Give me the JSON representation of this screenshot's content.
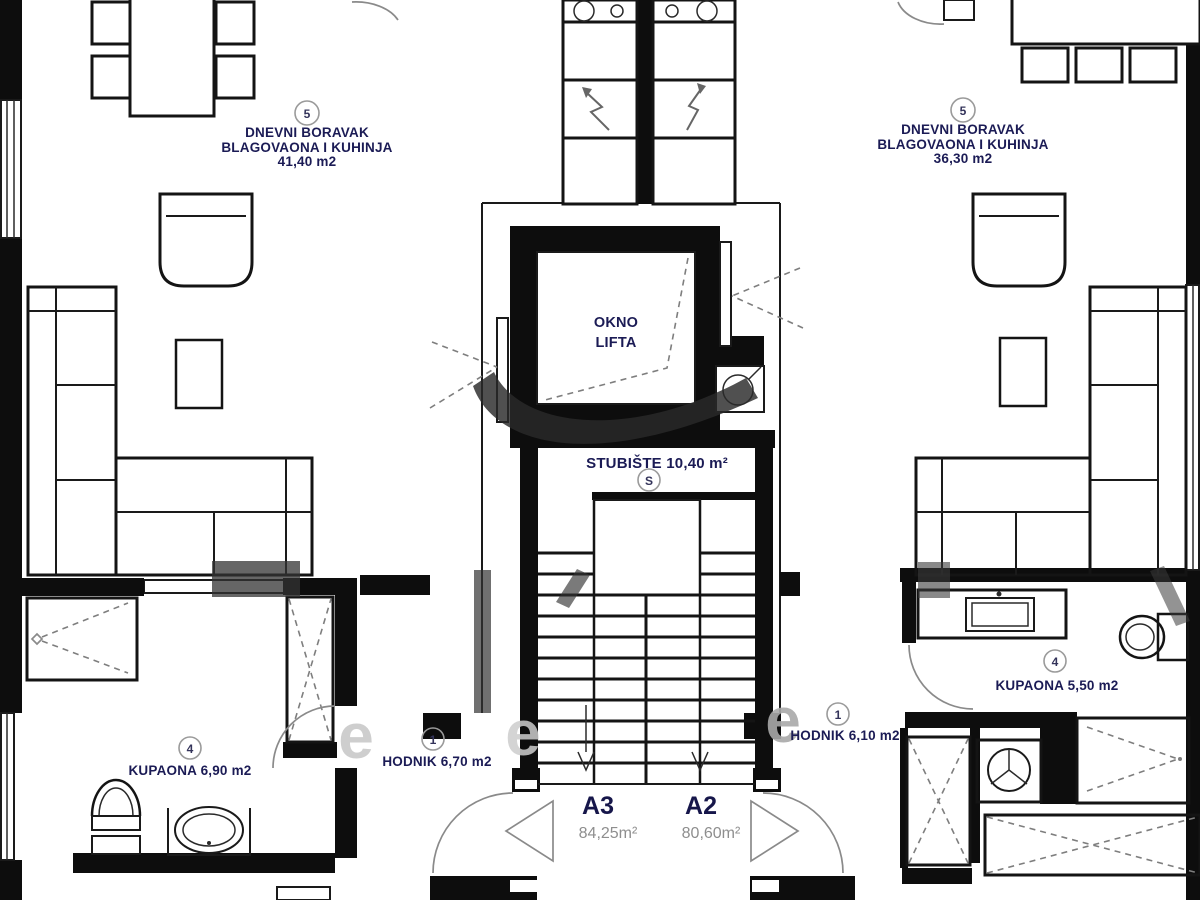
{
  "labels": {
    "left_unit": {
      "number": "5",
      "line1": "DNEVNI BORAVAK",
      "line2": "BLAGOVAONA I KUHINJA",
      "area": "41,40 m2"
    },
    "right_unit": {
      "number": "5",
      "line1": "DNEVNI BORAVAK",
      "line2": "BLAGOVAONA I KUHINJA",
      "area": "36,30 m2"
    },
    "elevator": {
      "line1": "OKNO",
      "line2": "LIFTA"
    },
    "stairs": {
      "label": "STUBIŠTE 10,40 m²",
      "symbol": "S"
    },
    "hall_left": {
      "number": "1",
      "label": "HODNIK 6,70 m2"
    },
    "hall_right": {
      "number": "1",
      "label": "HODNIK 6,10 m2"
    },
    "bath_left": {
      "number": "4",
      "label": "KUPAONA 6,90 m2"
    },
    "bath_right": {
      "number": "4",
      "label": "KUPAONA 5,50 m2"
    },
    "unit_left": {
      "id": "A3",
      "area": "84,25m²"
    },
    "unit_right": {
      "id": "A2",
      "area": "80,60m²"
    },
    "watermark": {
      "glyph1": "e",
      "glyph2": "e",
      "glyph3": "e"
    }
  },
  "colors": {
    "wall": "#0d0d0d",
    "label_text": "#1b1b55",
    "muted_text": "#8e8e8e",
    "thin_line": "#141414",
    "dashed_line": "#7e7e7e",
    "watermark_light": "#c9c9c9",
    "watermark_dark": "#333333"
  }
}
